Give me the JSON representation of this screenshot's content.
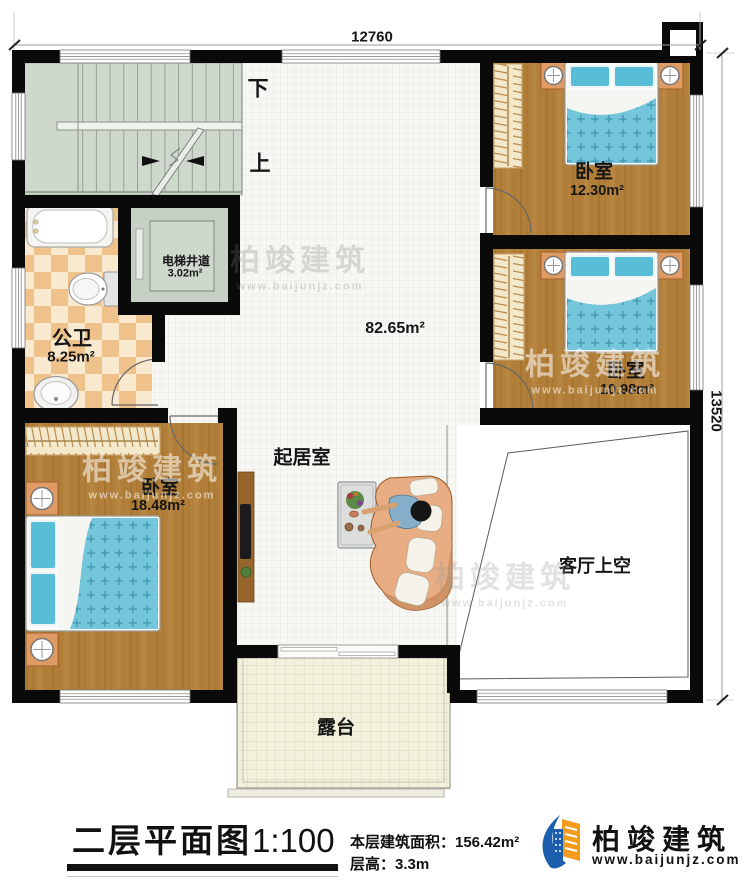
{
  "plan": {
    "dimensions": {
      "top": "12760",
      "right": "13520"
    },
    "stairs": {
      "down": "下",
      "up": "上"
    },
    "rooms": {
      "bedroom_top_right": {
        "name": "卧室",
        "area": "12.30m²"
      },
      "bedroom_mid_right": {
        "name": "卧室",
        "area": "10.98m²"
      },
      "bedroom_bottom_left": {
        "name": "卧室",
        "area": "18.48m²"
      },
      "bathroom": {
        "name": "公卫",
        "area": "8.25m²"
      },
      "elevator_shaft": {
        "name": "电梯井道",
        "area": "3.02m²"
      },
      "living_room": {
        "name": "起居室",
        "area": "82.65m²"
      },
      "living_void": {
        "name": "客厅上空"
      },
      "terrace": {
        "name": "露台"
      }
    }
  },
  "footer": {
    "title": "二层平面图",
    "scale": "1:100",
    "area_label": "本层建筑面积：156.42m²",
    "floor_height": "层高：3.3m",
    "logo_name": "柏竣建筑",
    "logo_url": "www.baijunjz.com"
  },
  "watermark": {
    "text": "柏竣建筑",
    "url": "www.baijunjz.com"
  },
  "colors": {
    "wall": "#0a0a0a",
    "wood_floor": "#b17f39",
    "bath_tile": "#efc28c",
    "stair_floor": "#ced8cd",
    "terrace_floor": "#f3f1dc",
    "bed_blue": "#74c7da",
    "logo_blue": "#1d5fae",
    "logo_orange": "#f29b1d"
  }
}
